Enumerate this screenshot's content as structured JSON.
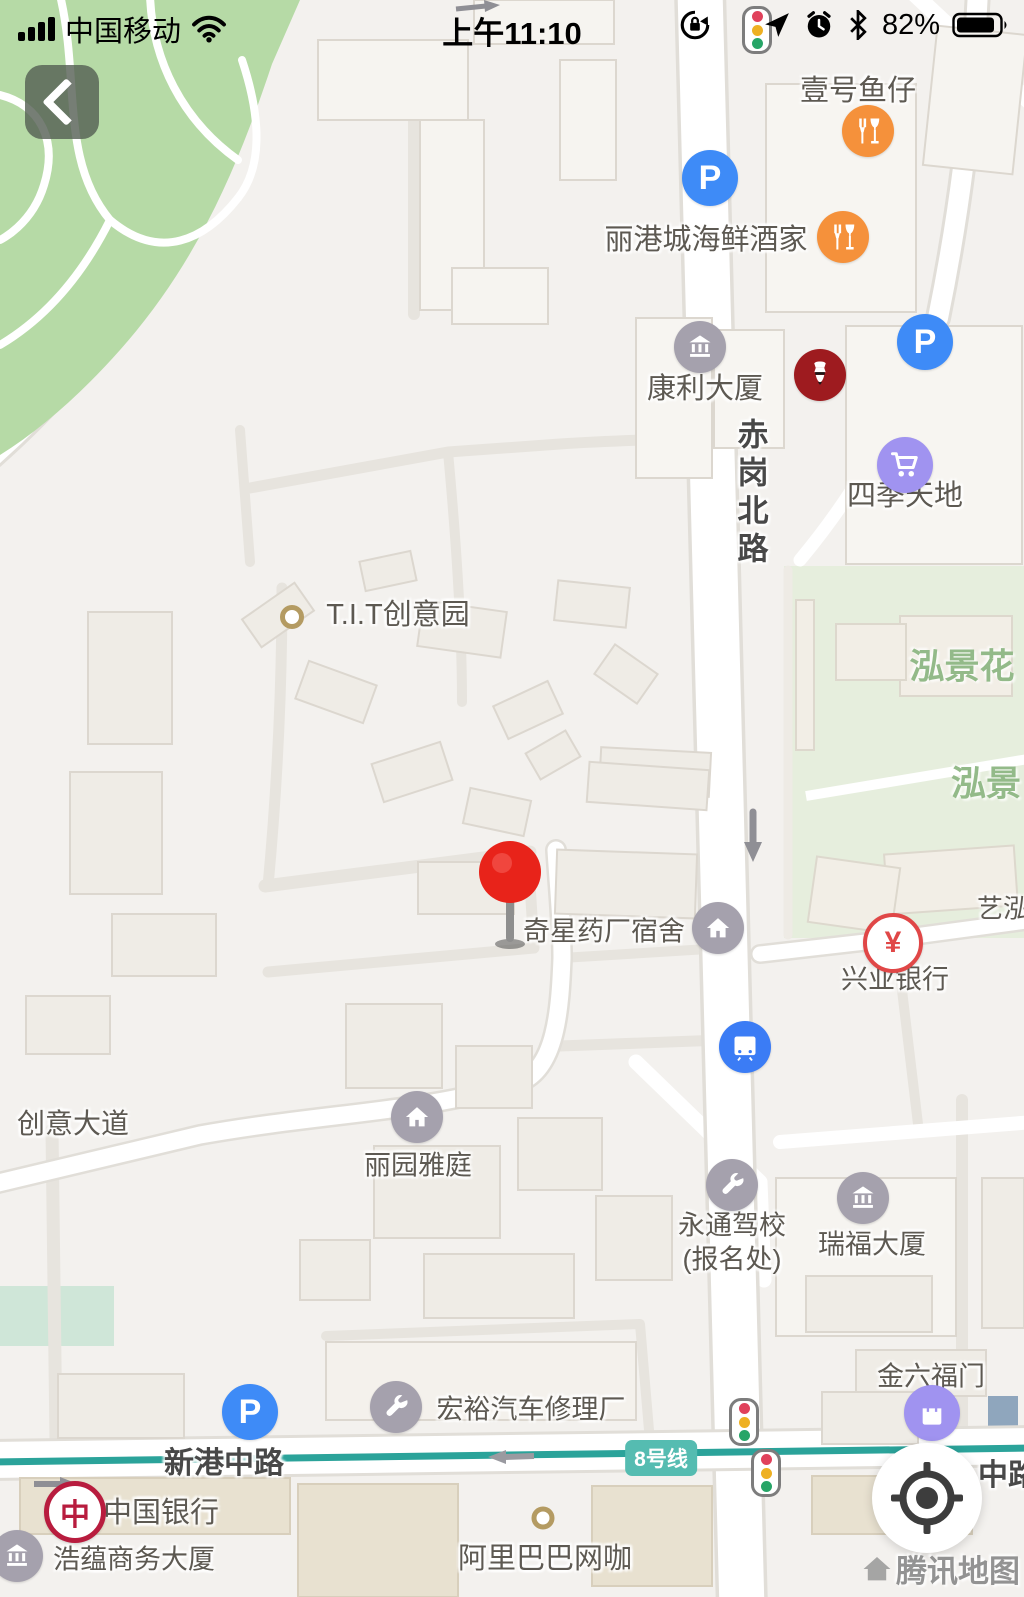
{
  "status_bar": {
    "carrier": "中国移动",
    "time": "上午11:10",
    "battery": "82%"
  },
  "pois": {
    "yihaoyuzai": "壹号鱼仔",
    "ligangcheng": "丽港城海鲜酒家",
    "kangli": "康利大厦",
    "siji": "四季天地",
    "tit": "T.I.T创意园",
    "qixing": "奇星药厂宿舍",
    "xingye": "兴业银行",
    "liyuan": "丽园雅庭",
    "yongtong_line1": "永通驾校",
    "yongtong_line2": "(报名处)",
    "ruifu": "瑞福大厦",
    "jinliufu": "金六福门",
    "hongyu": "宏裕汽车修理厂",
    "zhongguo_yinhang": "中国银行",
    "haoyun": "浩蕴商务大厦",
    "alibaba": "阿里巴巴网咖"
  },
  "roads": {
    "chigang_beilu": "赤岗北路",
    "xingang_zhonglu": "新港中路",
    "zhonglu_partial": "中路",
    "chuangyi_dadao": "创意大道",
    "line8_badge": "8号线"
  },
  "areas": {
    "hongjinghua": "泓景花",
    "hongjing": "泓景",
    "yihong": "艺泓"
  },
  "watermark": "腾讯地图",
  "glyphs": {
    "parking_letter": "P",
    "yuan_symbol": "¥",
    "boc_symbol": "中"
  },
  "icons": {
    "restaurant": "fork-and-goblet on orange circle",
    "parking": "white P on blue circle",
    "museum_building": "columned-building on gray circle",
    "shopping_cart": "cart on purple circle",
    "shopping_bag": "bag on purple circle",
    "home": "house on gray circle",
    "wrench": "wrench on gray circle",
    "metro": "train front on blue circle",
    "yuan_bank": "red yen sign in white ring",
    "kfc": "KFC colonel logo",
    "boc": "Bank of China coin emblem",
    "traffic_light": "red-yellow-green vertical light",
    "pin": "red dropped pin",
    "locate": "crosshair compass button"
  },
  "colors": {
    "poi_orange": "#f5913b",
    "parking_blue": "#3e8bf7",
    "transit_blue": "#3b7cf5",
    "poi_purple": "#a093f0",
    "poi_gray": "#a5a1ad",
    "pin_red": "#e8231a",
    "metro_teal": "#2ba39a",
    "metro_teal_badge": "#55bcb1",
    "park_green": "#b6daa6",
    "residential_green": "#e6eedd",
    "area_label_green": "#93ba89",
    "kfc_red": "#9e1b1f",
    "boc_red": "#b81c3e",
    "label_gray": "#5d5952"
  }
}
